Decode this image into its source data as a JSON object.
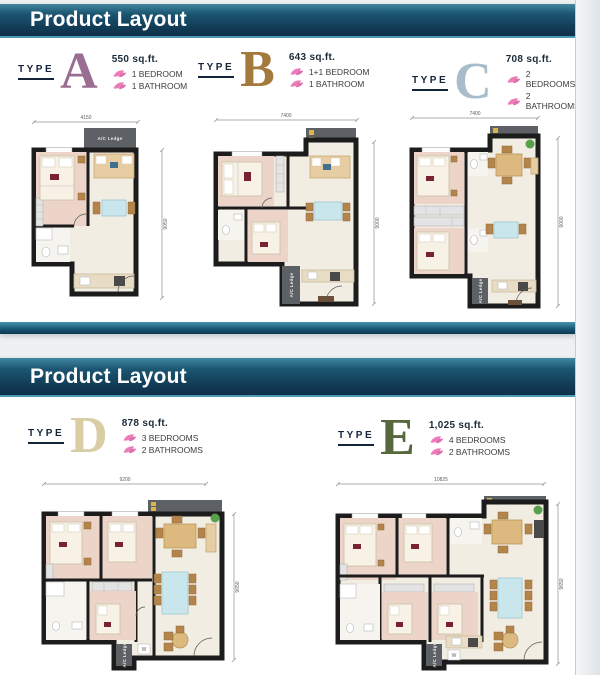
{
  "colors": {
    "header_bar_top": "#41889f",
    "header_bar_bottom": "#0f3049",
    "accent_strip": "#2d7f9f",
    "leaf_pink": "#ea7db8",
    "type_a_letter": "#9a6e93",
    "type_b_letter": "#a3793c",
    "type_c_letter": "#a9bcc9",
    "type_d_letter": "#d9cda6",
    "type_e_letter": "#57683c"
  },
  "shared": {
    "type_label": "TYPE",
    "ac_ledge_label": "A/C Ledge",
    "w_label": "W"
  },
  "slide1": {
    "header": "Product Layout",
    "types": [
      {
        "letter": "A",
        "area": "550 sq.ft.",
        "features": [
          "1 BEDROOM",
          "1 BATHROOM"
        ],
        "dim_width": "4150",
        "dim_height": "9050"
      },
      {
        "letter": "B",
        "area": "643 sq.ft.",
        "features": [
          "1+1 BEDROOM",
          "1 BATHROOM"
        ],
        "dim_width": "7400",
        "dim_height": "9000"
      },
      {
        "letter": "C",
        "area": "708 sq.ft.",
        "features": [
          "2 BEDROOMS",
          "2 BATHROOMS"
        ],
        "dim_width": "7400",
        "dim_height": "9000"
      }
    ]
  },
  "slide2": {
    "header": "Product Layout",
    "types": [
      {
        "letter": "D",
        "area": "878 sq.ft.",
        "features": [
          "3 BEDROOMS",
          "2 BATHROOMS"
        ],
        "dim_width": "9200",
        "dim_height": "9650"
      },
      {
        "letter": "E",
        "area": "1,025 sq.ft.",
        "features": [
          "4 BEDROOMS",
          "2 BATHROOMS"
        ],
        "dim_width": "10825",
        "dim_height": "9650"
      }
    ]
  }
}
